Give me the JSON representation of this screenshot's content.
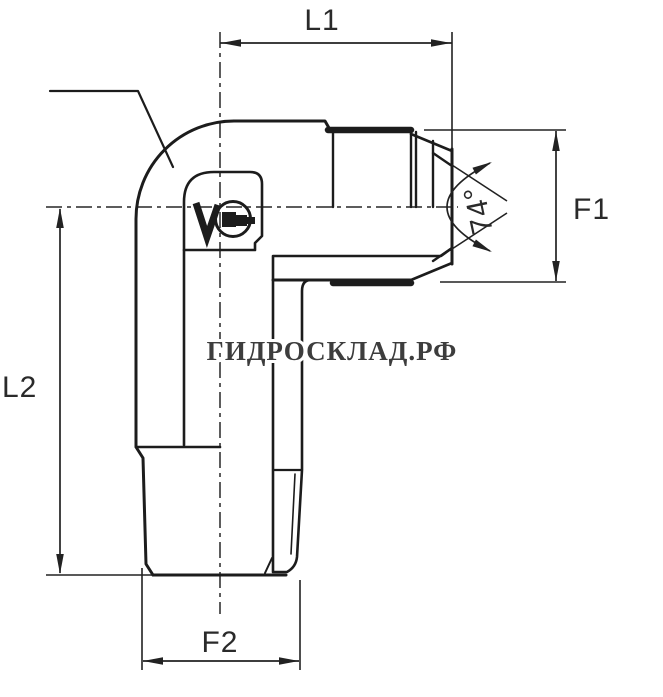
{
  "diagram": {
    "type": "technical-drawing",
    "subject": "90-degree elbow hydraulic adapter fitting, half-section side view",
    "labels": {
      "l1": "L1",
      "l2": "L2",
      "f1": "F1",
      "f2": "F2",
      "angle": "74°"
    },
    "watermark": "ГИДРОСКЛАД.РФ",
    "colors": {
      "line": "#1c1c1c",
      "dimension": "#222222",
      "watermark": "#3d3d3d",
      "background": "#ffffff"
    }
  }
}
